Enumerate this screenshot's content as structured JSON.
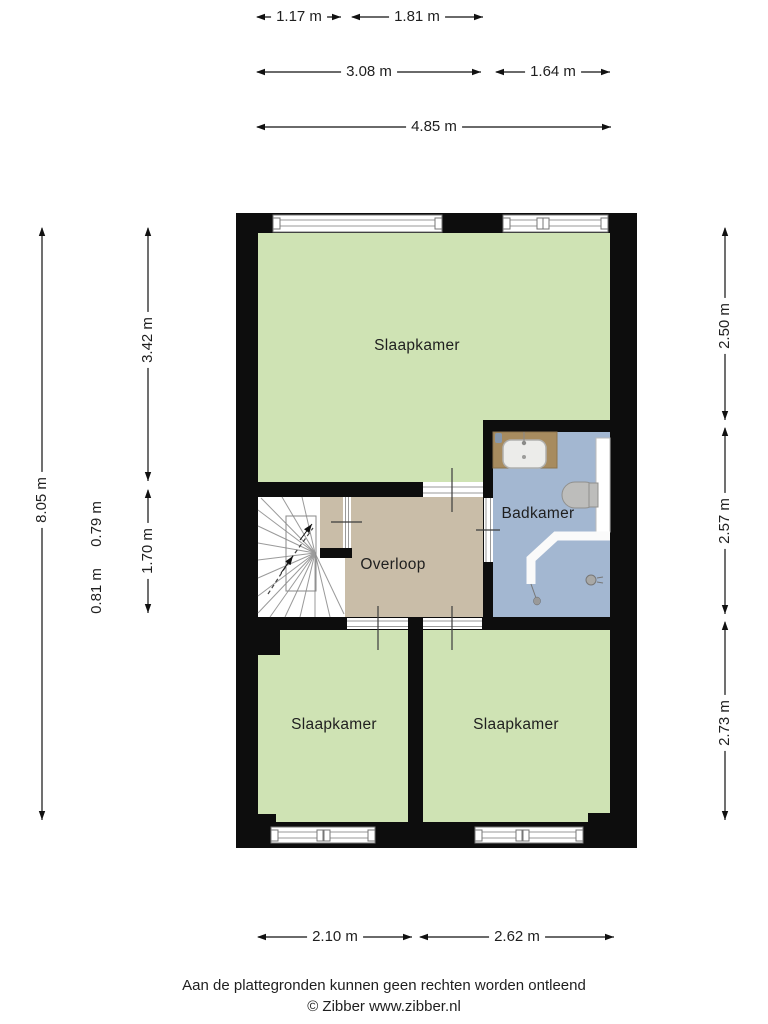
{
  "floorplan": {
    "rooms": {
      "bedroom_top": {
        "label": "Slaapkamer"
      },
      "bathroom": {
        "label": "Badkamer"
      },
      "landing": {
        "label": "Overloop"
      },
      "bedroom_left": {
        "label": "Slaapkamer"
      },
      "bedroom_right": {
        "label": "Slaapkamer"
      }
    },
    "fixtures": [
      "stairs",
      "sink",
      "toilet",
      "shower",
      "drain"
    ],
    "colors": {
      "room_fill": "#cfe3b4",
      "bathroom_fill": "#a3b7d1",
      "landing_fill": "#c9bda8",
      "wall": "#0d0d0d",
      "counter": "#a78b5f",
      "fixture_gray": "#bdbdbb"
    }
  },
  "dimensions": {
    "top_row1": [
      "1.17 m",
      "1.81 m"
    ],
    "top_row2": [
      "3.08 m",
      "1.64 m"
    ],
    "top_row3": [
      "4.85 m"
    ],
    "left_outer": "8.05 m",
    "left_inner": [
      "0.79 m",
      "0.81 m"
    ],
    "left_rooms": [
      "3.42 m",
      "1.70 m"
    ],
    "right": [
      "2.50 m",
      "2.57 m",
      "2.73 m"
    ],
    "bottom": [
      "2.10 m",
      "2.62 m"
    ]
  },
  "footer": {
    "disclaimer": "Aan de plattegronden kunnen geen rechten worden ontleend",
    "copyright": "© Zibber www.zibber.nl"
  }
}
